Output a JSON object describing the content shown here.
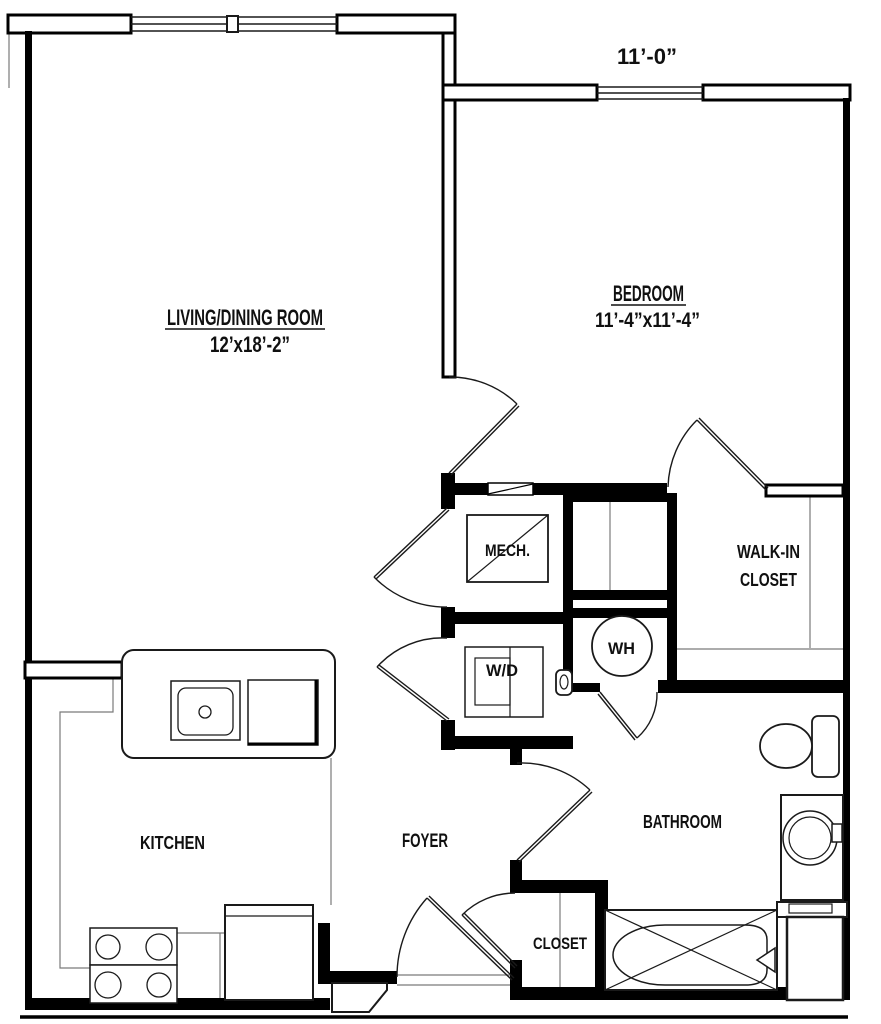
{
  "plan": {
    "type": "apartment-floor-plan",
    "colors": {
      "walls": "#000000",
      "thin_lines": "#7a7a7a",
      "background": "#ffffff"
    },
    "labels": {
      "window_dim": "11’-0”",
      "living": {
        "name": "LIVING/DINING ROOM",
        "dim": "12’x18’-2”"
      },
      "bedroom": {
        "name": "BEDROOM",
        "dim": "11’-4”x11’-4”"
      },
      "kitchen": "KITCHEN",
      "foyer": "FOYER",
      "bathroom": "BATHROOM",
      "closet": "CLOSET",
      "walkin1": "WALK-IN",
      "walkin2": "CLOSET",
      "mech": "MECH.",
      "wd": "W/D",
      "wh": "WH"
    }
  }
}
